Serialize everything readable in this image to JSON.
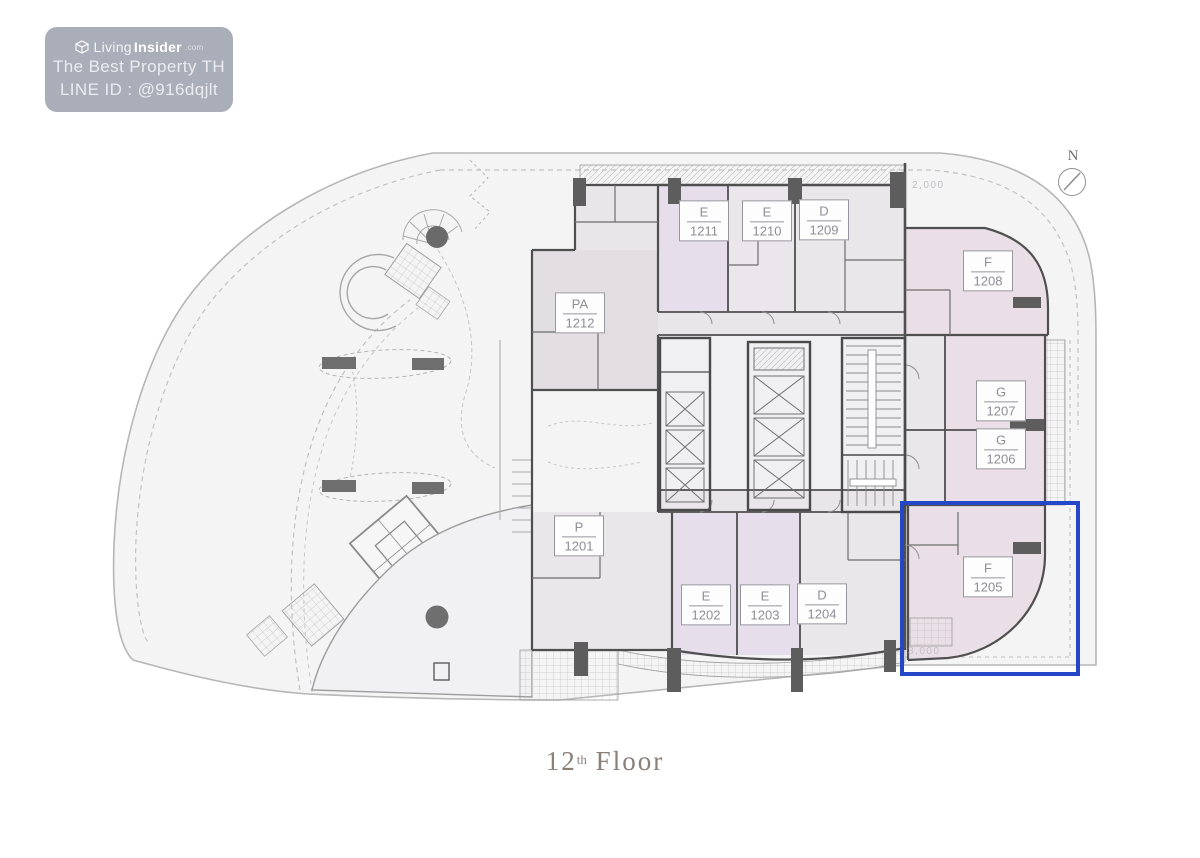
{
  "page": {
    "background": "#ffffff",
    "description": "Condominium 12th floor plan with garden terrace, unit F-1205 highlighted in blue"
  },
  "watermark": {
    "logo_icon": "cube-logo",
    "brand_light": "Living",
    "brand_bold": "Insider",
    "brand_suffix": ".com",
    "line_property": "The Best Property TH",
    "line_id": "LINE ID : @916dqjlt",
    "bg_color": "#9EA3AF",
    "text_color": "#EEF0F4"
  },
  "caption": {
    "number": "12",
    "ordinal": "th",
    "word": "Floor",
    "color": "#8A8078"
  },
  "compass": {
    "label": "N",
    "icon": "north-compass-circle-needle"
  },
  "highlight": {
    "unit": "F-1205",
    "color": "#2447C9"
  },
  "dimensions": {
    "top": "2,000",
    "bottom": "3,000"
  },
  "units": [
    {
      "type": "E",
      "number": "1211"
    },
    {
      "type": "E",
      "number": "1210"
    },
    {
      "type": "D",
      "number": "1209"
    },
    {
      "type": "PA",
      "number": "1212"
    },
    {
      "type": "F",
      "number": "1208"
    },
    {
      "type": "G",
      "number": "1207"
    },
    {
      "type": "G",
      "number": "1206"
    },
    {
      "type": "F",
      "number": "1205"
    },
    {
      "type": "P",
      "number": "1201"
    },
    {
      "type": "E",
      "number": "1202"
    },
    {
      "type": "E",
      "number": "1203"
    },
    {
      "type": "D",
      "number": "1204"
    }
  ],
  "colors": {
    "highlight_blue": "#2447C9",
    "wall": "#4F4F4F",
    "unit_lavender": "#E6DEEA",
    "unit_mauve": "#EADFE6",
    "unit_gray": "#E9E7E9",
    "lot_fill": "#F4F4F5",
    "label_text": "#8F8D96",
    "caption_text": "#8A8078"
  }
}
